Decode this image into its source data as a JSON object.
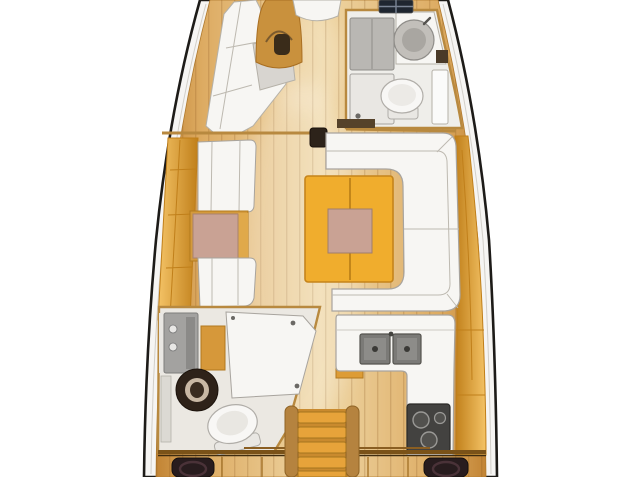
{
  "colors": {
    "background": "#ffffff",
    "hull_line": "#1d1b18",
    "hull_band": "#f6f5f3",
    "hull_inner_line": "#d2cfc9",
    "wood_edge": "#c28434",
    "wood_mid": "#ddab62",
    "wood_light": "#efd7a6",
    "wall_tan": "#b8893f",
    "furniture_yellow": "#eca72e",
    "furniture_yellow_dark": "#c07f1a",
    "furniture_yellow_hi": "#f4c366",
    "upholstery_white": "#f7f6f3",
    "upholstery_line": "#a8a49e",
    "cushion_gray": "#d8d5d0",
    "small_table_wood": "#d49a3c",
    "table_pink": "#c9a294",
    "salon_table_yellow": "#f0ad2d",
    "salon_table_edge": "#c5841b",
    "gray_panel": "#a3a2a0",
    "light_panel": "#e9e7e3",
    "sink_steel": "#7b7a77",
    "steel_dark": "#3a3936",
    "stove_dark": "#434240",
    "mast_post_dark": "#2d231a",
    "hatch_dark": "#1f2630",
    "hatch_grid": "#7a8494",
    "speaker_dark": "#281c1e",
    "speaker_ring": "#4a3238",
    "steps_tread": "#e7a33a",
    "steps_rail": "#b5833f",
    "steps_box": "#c98a2e",
    "arch_wood": "#c9913d",
    "arch_opening": "#3a2c1a",
    "door_shadow": "#55422a",
    "round_sink_dark": "#2e2219",
    "round_sink_ring": "#c9b8a4",
    "toilet_white": "#f8f7f5",
    "toilet_line": "#b0ada8",
    "room_floor": "#ebe8e2",
    "head_floor": "#efeeea"
  }
}
